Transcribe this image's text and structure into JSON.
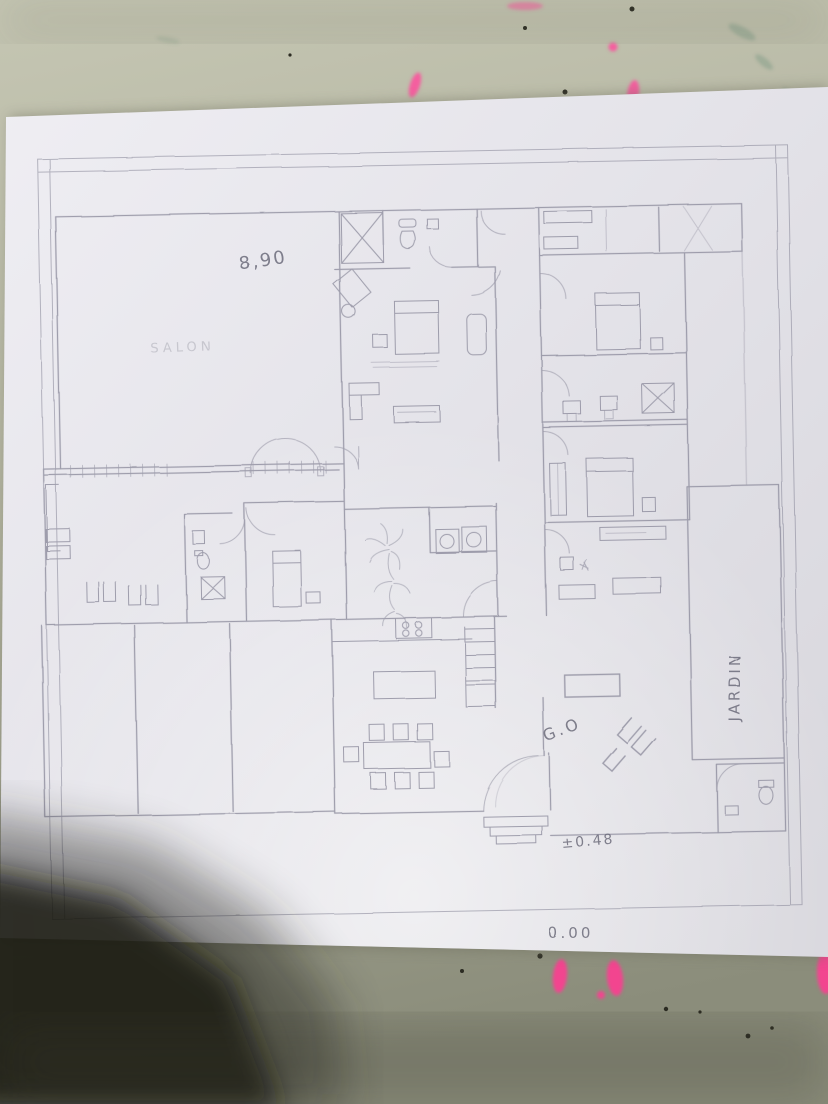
{
  "photo": {
    "annotations": {
      "dimension_top": "8,90",
      "room_label_faint": "SALON",
      "garden_label": "JARDIN",
      "sofa_note": "G.O",
      "level_entry": "±0.48",
      "level_base": "0.00"
    },
    "colors": {
      "table_surface": "#b4b5a1",
      "paper": "#e7e6eb",
      "pencil_line": "#8b8a9b",
      "graphite_text": "#6c6b7a",
      "pink_marker": "#f45f9f",
      "hand_shadow": "#1a1b15"
    }
  }
}
